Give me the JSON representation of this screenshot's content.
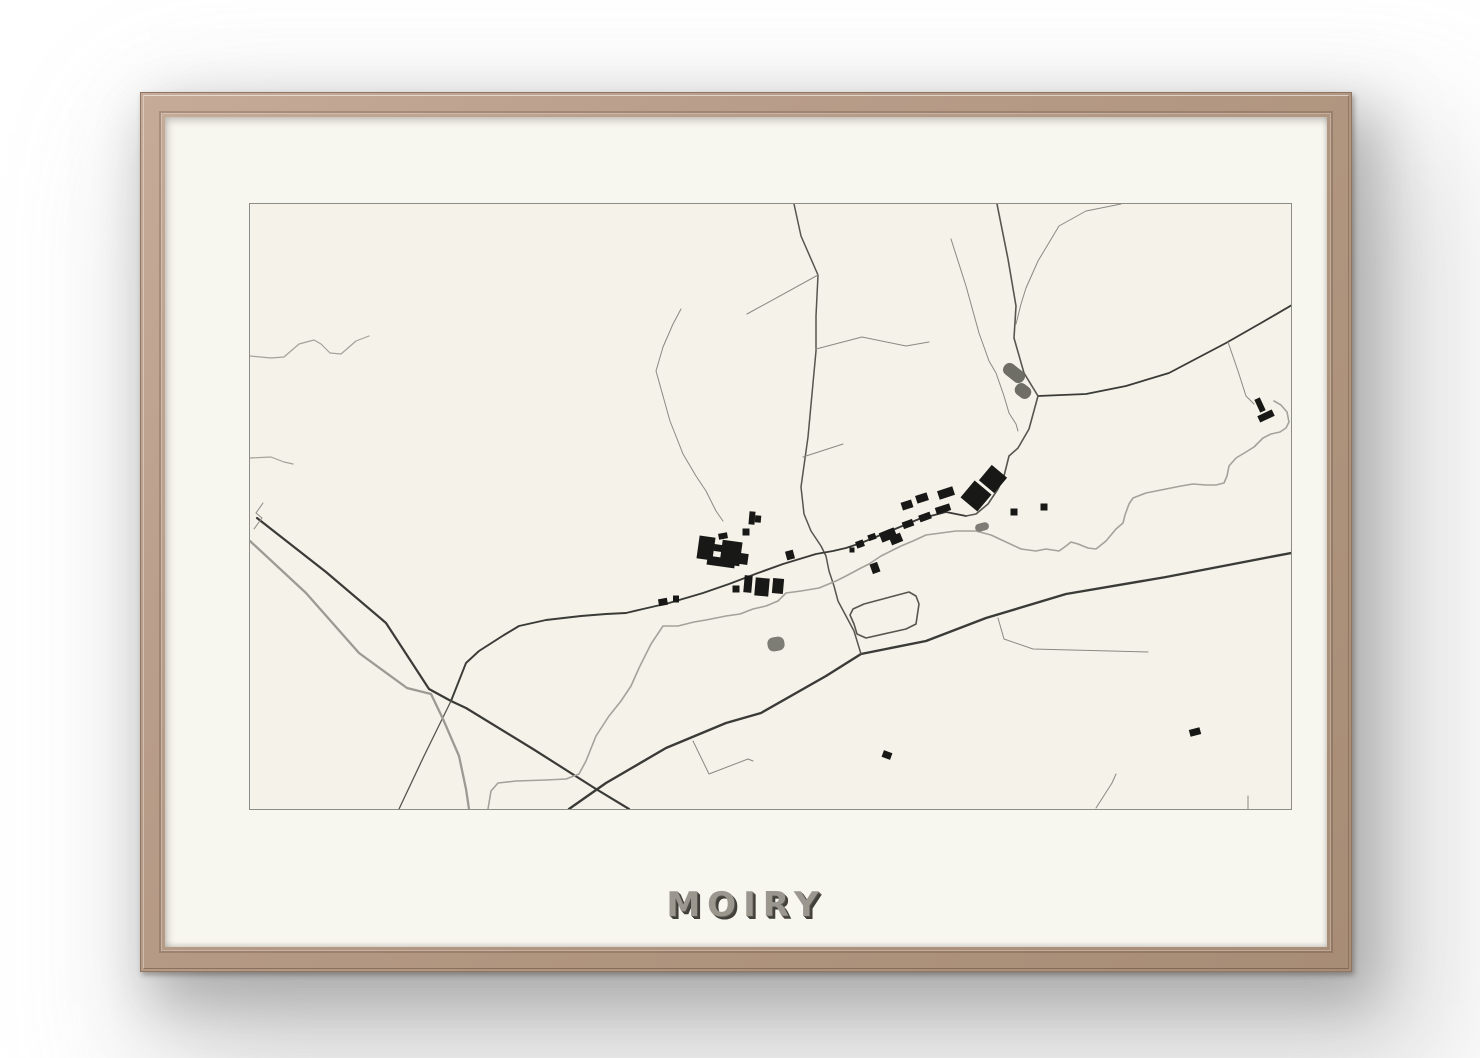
{
  "poster": {
    "title": "MOIRY",
    "palette": {
      "frame_wood": "#b89d8a",
      "mat": "#f7f6ef",
      "map_bg": "#f4f2e9",
      "map_border": "#8d8d87",
      "road_dark": "#3a3a37",
      "road_medium": "#56564f",
      "road_gray": "#9b9b94",
      "path_thin": "#8a8a83",
      "water": "#a3a39b",
      "building": "#181816",
      "pond_dark": "#6e6e67",
      "pond_light": "#7d7d75",
      "title_face": "#9b978f",
      "title_shadow": "#413f39"
    }
  },
  "map": {
    "viewbox": "0 0 1041 605",
    "paths": [
      {
        "name": "road-sw-diagonal",
        "k": "dark",
        "w": 2.2,
        "d": "M7,314 L76,368 136,419 179,485 201,497 216,504 283,545 346,585 379,605"
      },
      {
        "name": "road-main-south",
        "k": "dark",
        "w": 2.4,
        "d": "M319,605 L356,579 416,544 476,519 511,509 576,472 611,450 676,437 736,414 816,390 916,373 1041,349"
      },
      {
        "name": "road-ne-to-border",
        "k": "dark",
        "w": 1.8,
        "d": "M788,192 L836,190 876,182 919,169 976,139 1011,119 1042,101"
      },
      {
        "name": "road-from-top-curve",
        "k": "medium",
        "w": 1.6,
        "d": "M747,0 L758,55 766,102 764,134 774,169 788,192"
      },
      {
        "name": "road-vertical-village",
        "k": "medium",
        "w": 1.5,
        "d": "M544,0 L551,32 568,71 566,112 566,147 558,233 551,283 554,310 561,327 571,342 576,352 579,367 584,382 588,397 596,412 604,427 611,450"
      },
      {
        "name": "road-village-street",
        "k": "dark",
        "w": 1.9,
        "d": "M201,497 L216,459 229,447 254,431 269,422 296,416 331,412 356,410 376,409 393,405 419,399 453,389 479,380 508,369 533,360 566,350 583,347 596,344 611,339 638,328 669,315 696,308 716,312"
      },
      {
        "name": "road-curve-around-squares",
        "k": "medium",
        "w": 1.6,
        "d": "M788,192 L779,225 768,244 759,252 754,272 748,285 738,300 726,310 716,312"
      },
      {
        "name": "road-loop-track",
        "k": "medium",
        "w": 1.6,
        "d": "M604,420 L600,411 603,405 614,400 659,388 666,392 669,400 666,420 656,425 616,434 607,430 Z"
      },
      {
        "name": "road-branch-south",
        "k": "medium",
        "w": 1.3,
        "d": "M201,497 L174,552 149,605"
      },
      {
        "name": "road-gray-parallel",
        "k": "gray",
        "w": 2.3,
        "d": "M0,337 L56,389 109,449 157,484 181,490 193,515 209,552 216,585 219,605"
      },
      {
        "name": "branch-upper-left",
        "k": "thin",
        "w": 1,
        "d": "M568,71 L497,110"
      },
      {
        "name": "branch-east-hook",
        "k": "thin",
        "w": 1,
        "d": "M566,145 L612,133 656,142 679,138"
      },
      {
        "name": "branch-small-east",
        "k": "thin",
        "w": 1,
        "d": "M553,253 L593,240"
      },
      {
        "name": "branch-se-field",
        "k": "thin",
        "w": 1,
        "d": "M748,414 L754,435 783,445 898,448"
      },
      {
        "name": "branch-south-field",
        "k": "thin",
        "w": 1,
        "d": "M443,537 L459,570 498,555 503,557"
      },
      {
        "name": "branch-ne-corner",
        "k": "thin",
        "w": 1,
        "d": "M978,138 L988,167 996,192 1004,200"
      },
      {
        "name": "tick-bottom-right-a",
        "k": "thin",
        "w": 1,
        "d": "M846,604 L862,579 866,570"
      },
      {
        "name": "tick-bottom-right-b",
        "k": "thin",
        "w": 1,
        "d": "M998,592 L998,605"
      },
      {
        "name": "lane-center-fields",
        "k": "thin",
        "w": 1,
        "d": "M431,105 L423,120 413,143 406,167 420,217 433,250 446,272 456,287 466,307 473,317"
      },
      {
        "name": "lane-ne-from-top",
        "k": "thin",
        "w": 1,
        "d": "M871,0 L836,7 809,22 788,57 776,84 771,100 766,120"
      },
      {
        "name": "lane-parallel-ne",
        "k": "thin",
        "w": 1,
        "d": "M701,35 L716,82 729,129 739,157 746,169 754,192 759,209 766,220 768,227"
      },
      {
        "name": "river-main",
        "k": "water",
        "w": 1.6,
        "d": "M238,605 L241,587 248,579 266,577 296,576 316,575 329,570 336,557 346,532 359,512 371,497 381,482 389,464 401,440 413,422 428,422 444,418 456,416 476,412 490,410 503,405 516,402 528,397 536,389 551,387 569,384 586,377 596,372 611,364 619,360 631,352 641,347 651,342 663,337 676,331 691,329 706,327 726,327 741,331 756,338 771,345 786,347 796,345 809,347 816,342 821,338 828,340 838,344 846,345 856,337 866,325 873,319 875,311 879,300 883,294 896,289 916,285 931,282 943,280 956,281 966,281 974,279 977,272 979,262 986,254 996,248 1004,243 1013,234 1021,230 1030,228 1036,224 1039,218 1037,208 1031,201 1024,197"
      },
      {
        "name": "stream-northwest",
        "k": "water",
        "w": 1.2,
        "d": "M0,152 L21,154 34,153 49,140 64,136 71,140 80,149 91,150 106,137 119,132"
      },
      {
        "name": "stream-west-short",
        "k": "water",
        "w": 1.2,
        "d": "M0,254 L21,253 34,258 43,260"
      },
      {
        "name": "zigzag-west",
        "k": "thin",
        "w": 1,
        "d": "M13,299 L6,309 12,314 4,325"
      }
    ],
    "ponds": [
      {
        "name": "pond-north-a",
        "cx": 764,
        "cy": 169,
        "w": 24,
        "h": 13,
        "rot": 38,
        "rx": 6,
        "k": "pond_dark"
      },
      {
        "name": "pond-north-b",
        "cx": 773,
        "cy": 187,
        "w": 17,
        "h": 13,
        "rot": 38,
        "rx": 6,
        "k": "pond_dark"
      },
      {
        "name": "pond-village",
        "cx": 732,
        "cy": 323,
        "w": 14,
        "h": 8,
        "rot": -15,
        "rx": 4,
        "k": "pond_light"
      },
      {
        "name": "pond-southwest",
        "cx": 526,
        "cy": 440,
        "w": 17,
        "h": 14,
        "rot": -10,
        "rx": 6,
        "k": "pond_light"
      }
    ],
    "buildings": [
      [
        456,
        344,
        16,
        23,
        8
      ],
      [
        481,
        349,
        20,
        24,
        8
      ],
      [
        468,
        344,
        8,
        7,
        8
      ],
      [
        471,
        358,
        28,
        9,
        8
      ],
      [
        494,
        355,
        8,
        11,
        8
      ],
      [
        496,
        328,
        7,
        7,
        0
      ],
      [
        502,
        314,
        6,
        13,
        5
      ],
      [
        508,
        315,
        6,
        7,
        5
      ],
      [
        473,
        332,
        9,
        6,
        -10
      ],
      [
        498,
        380,
        8,
        17,
        5
      ],
      [
        512,
        383,
        14,
        18,
        5
      ],
      [
        528,
        382,
        11,
        15,
        5
      ],
      [
        486,
        385,
        7,
        7,
        0
      ],
      [
        413,
        398,
        9,
        7,
        -10
      ],
      [
        426,
        395,
        6,
        7,
        0
      ],
      [
        625,
        364,
        8,
        10,
        -20
      ],
      [
        540,
        351,
        8,
        9,
        -15
      ],
      [
        743,
        275,
        20,
        20,
        40
      ],
      [
        726,
        292,
        22,
        22,
        40
      ],
      [
        696,
        289,
        16,
        9,
        -18
      ],
      [
        672,
        294,
        12,
        8,
        -18
      ],
      [
        657,
        301,
        11,
        8,
        -18
      ],
      [
        638,
        331,
        16,
        10,
        -22
      ],
      [
        646,
        335,
        12,
        9,
        -22
      ],
      [
        622,
        333,
        8,
        6,
        -20
      ],
      [
        610,
        340,
        8,
        7,
        -20
      ],
      [
        658,
        320,
        11,
        7,
        -20
      ],
      [
        675,
        313,
        12,
        7,
        -20
      ],
      [
        693,
        305,
        15,
        7,
        -18
      ],
      [
        764,
        308,
        7,
        7,
        0
      ],
      [
        794,
        303,
        7,
        7,
        0
      ],
      [
        1010,
        201,
        14,
        6,
        65
      ],
      [
        1016,
        212,
        16,
        7,
        -25
      ],
      [
        945,
        528,
        11,
        7,
        -15
      ],
      [
        637,
        551,
        9,
        7,
        20
      ],
      [
        602,
        346,
        5,
        5,
        0
      ]
    ]
  }
}
